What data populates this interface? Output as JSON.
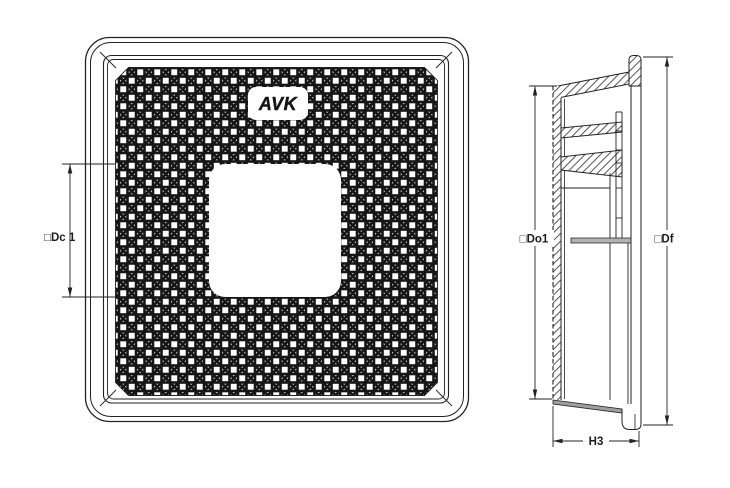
{
  "logo": {
    "text": "AVK"
  },
  "dimensions": {
    "dc1": {
      "label": "□Dc 1"
    },
    "do1": {
      "label": "□Do1"
    },
    "df": {
      "label": "□Df"
    },
    "h3": {
      "label": "H3"
    }
  },
  "colors": {
    "line": "#222222",
    "background": "#ffffff",
    "pattern_dark": "#161616",
    "shade_gray": "#9e9e9e",
    "seat_gray": "#b3b3b3"
  }
}
